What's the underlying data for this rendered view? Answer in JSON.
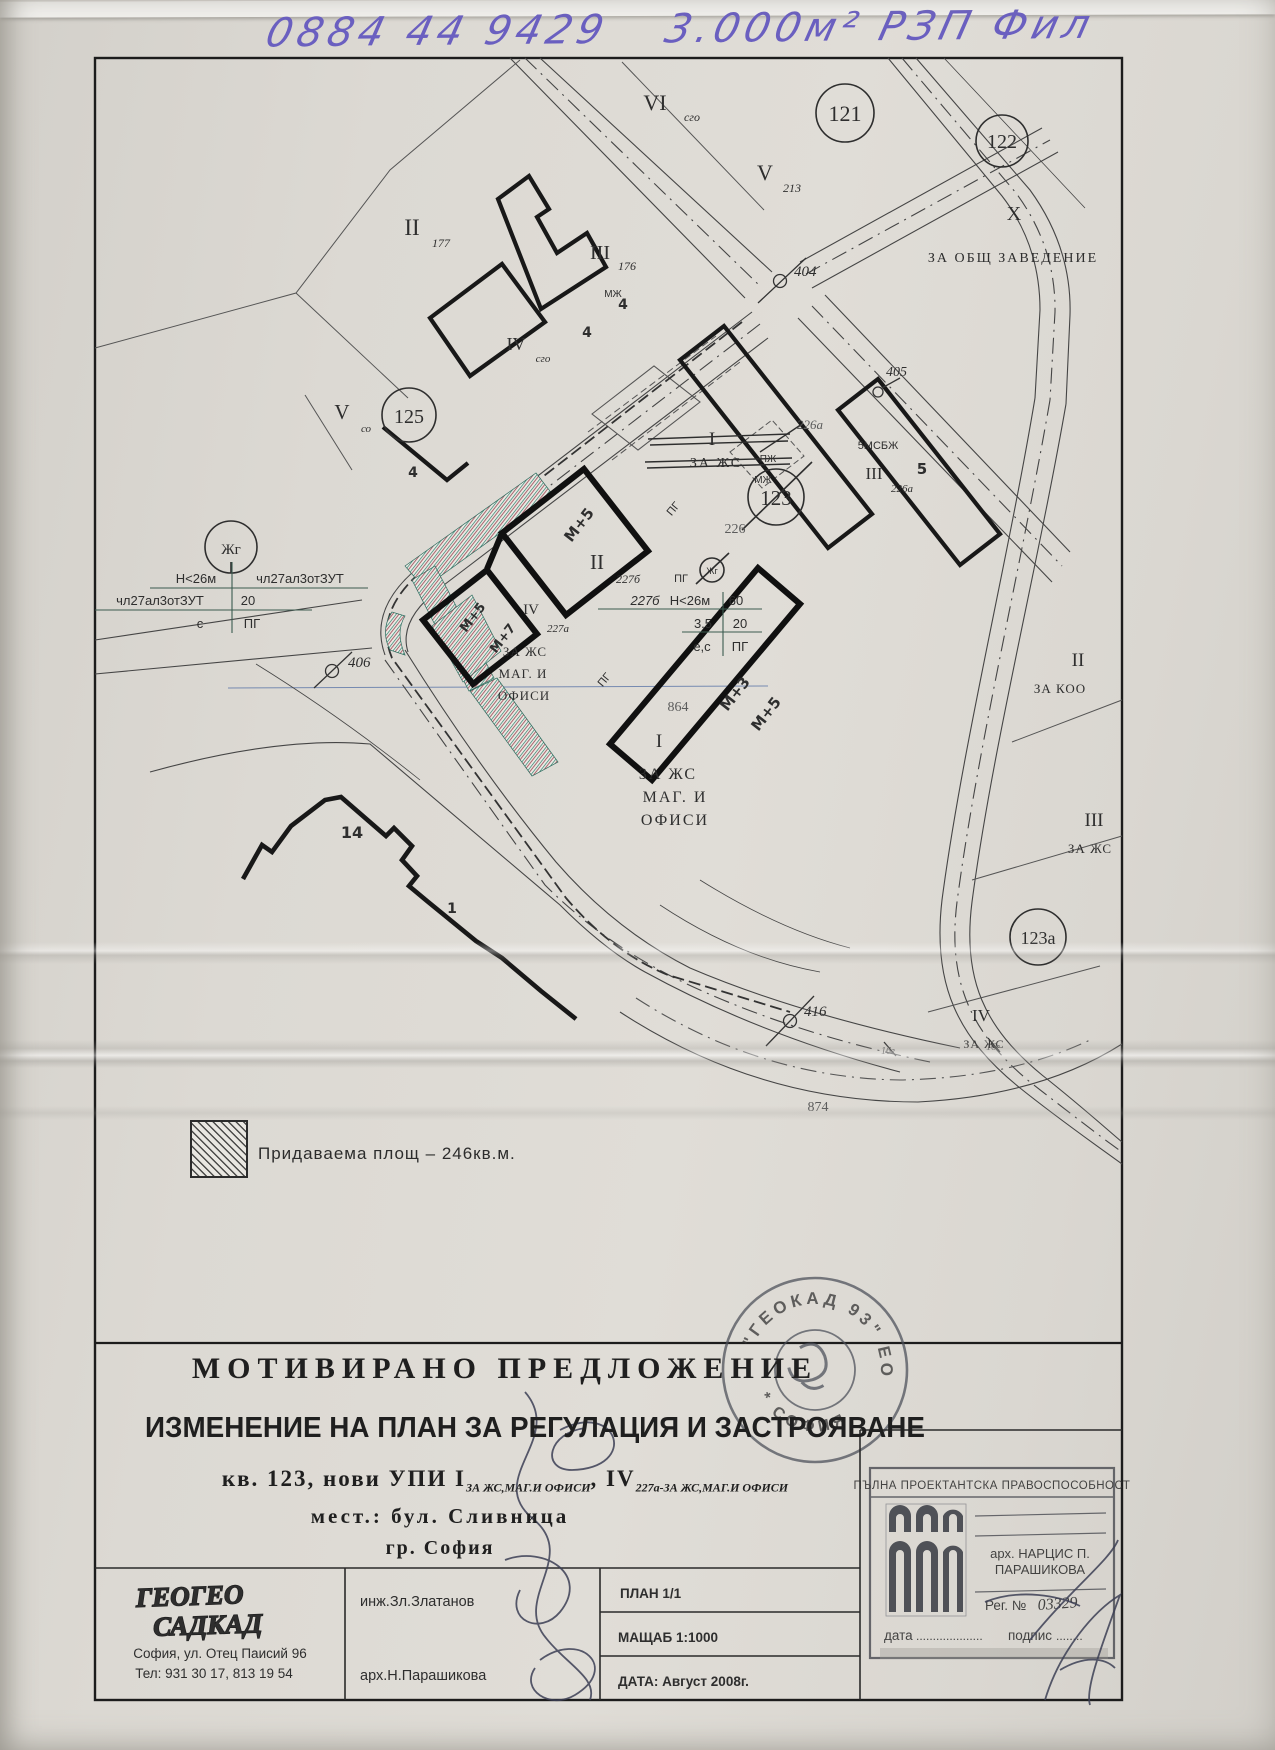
{
  "handwriting": {
    "phone": "0884 44 9429",
    "note": "3.000м² РЗП Фил"
  },
  "plan": {
    "labels": {
      "vi": "VI",
      "vi_s": "сго",
      "v213": "V",
      "v213_s": "213",
      "x_num": "Х",
      "x_use": "ЗА ОБЩ ЗАВЕДЕНИЕ",
      "ii177": "II",
      "ii177_s": "177",
      "iii176": "III",
      "iii176_s": "176",
      "mzh": "МЖ",
      "n4a": "4",
      "n4b": "4",
      "n4c": "4",
      "iv_sgo": "IV",
      "iv_sgo_s": "сго",
      "v_so": "V",
      "v_so_s": "со",
      "i_old": "I",
      "i_old_use": "ЗА ЖС",
      "pzh": "ПЖ",
      "mzh2": "МЖ",
      "p226a": "226а",
      "msbzh": "5МСБЖ",
      "iii5": "III",
      "n5": "5",
      "p226a2": "226а",
      "pg1": "ПГ",
      "pg2": "ПГ",
      "pg3": "ПГ",
      "p226": "226",
      "zhg_s": "Жг",
      "m5a": "М+5",
      "ii227b": "II",
      "ii227b_s": "227б",
      "m5b": "М+5",
      "m7": "М+7",
      "iv227a": "IV",
      "iv227a_s": "227а",
      "s1": "ЗА ЖС",
      "s2": "МАГ. И",
      "s3": "ОФИСИ",
      "i_new": "I",
      "b1": "ЗА ЖС",
      "b2": "МАГ. И",
      "b3": "ОФИСИ",
      "p864": "864",
      "m3": "М+3",
      "m5c": "М+5",
      "p14": "14",
      "p1": "1",
      "g16a": "16г",
      "g16b": "16г",
      "p874": "874",
      "ii_koo": "II",
      "ii_koo_use": "ЗА КОО",
      "iii_zhs": "III",
      "iii_zhs_use": "ЗА ЖС",
      "iv_zhs": "IV",
      "iv_zhs_use": "ЗА ЖС"
    },
    "circles": {
      "c121": "121",
      "c122": "122",
      "c125": "125",
      "c123": "123",
      "c123a": "123а",
      "zhg": "Жг"
    },
    "markers": {
      "m404": "404",
      "m405": "405",
      "m406": "406",
      "m416": "416"
    },
    "ann1": {
      "r1a": "Н<26м",
      "r1b": "чл27ал3отЗУТ",
      "r2a": "чл27ал3отЗУТ",
      "r2b": "20",
      "r3a": "с",
      "r3b": "ПГ"
    },
    "ann2": {
      "r1a": "227б",
      "r1b": "Н<26м",
      "r1c": "60",
      "r2a": "3.5",
      "r2b": "20",
      "r3a": "е,с",
      "r3b": "ПГ"
    }
  },
  "legend": {
    "label": "Придаваема площ  –  246кв.м."
  },
  "title": {
    "l1": "МОТИВИРАНО  ПРЕДЛОЖЕНИЕ",
    "l2": "ИЗМЕНЕНИЕ НА ПЛАН ЗА РЕГУЛАЦИЯ И ЗАСТРОЯВАНЕ",
    "l3_pre": "кв. 123, нови УПИ I",
    "l3_sub1": "ЗА ЖС,МАГ.И ОФИСИ",
    "l3_mid": ", IV",
    "l3_sub2": "227а-ЗА ЖС,МАГ.И ОФИСИ",
    "l4": "мест.: бул. Сливница",
    "l5": "гр. София"
  },
  "stamp": {
    "top": "\"ГЕОКАД 93\" ЕООД",
    "bottom": "* СОФИЯ *"
  },
  "cert": {
    "header": "ПЪЛНА ПРОЕКТАНТСКА ПРАВОСПОСОБНОСТ",
    "name1": "арх. НАРЦИС П.",
    "name2": "ПАРАШИКОВА",
    "reg": "Рег. №",
    "reg_no": "03329",
    "date_label": "дата",
    "date_dots": "....................",
    "sign_label": "подпис",
    "sign_dots": "........"
  },
  "footer": {
    "logo1": "ГЕОГЕО",
    "logo2": "САДКАД",
    "address": "София,  ул. Отец Паисий  96",
    "phone": "Тел: 931 30 17, 813 19 54",
    "eng": "инж.Зл.Златанов",
    "arch": "арх.Н.Парашикова",
    "plan_no": "ПЛАН 1/1",
    "scale": "МАЩАБ 1:1000",
    "date": "ДАТА:  Август 2008г."
  }
}
